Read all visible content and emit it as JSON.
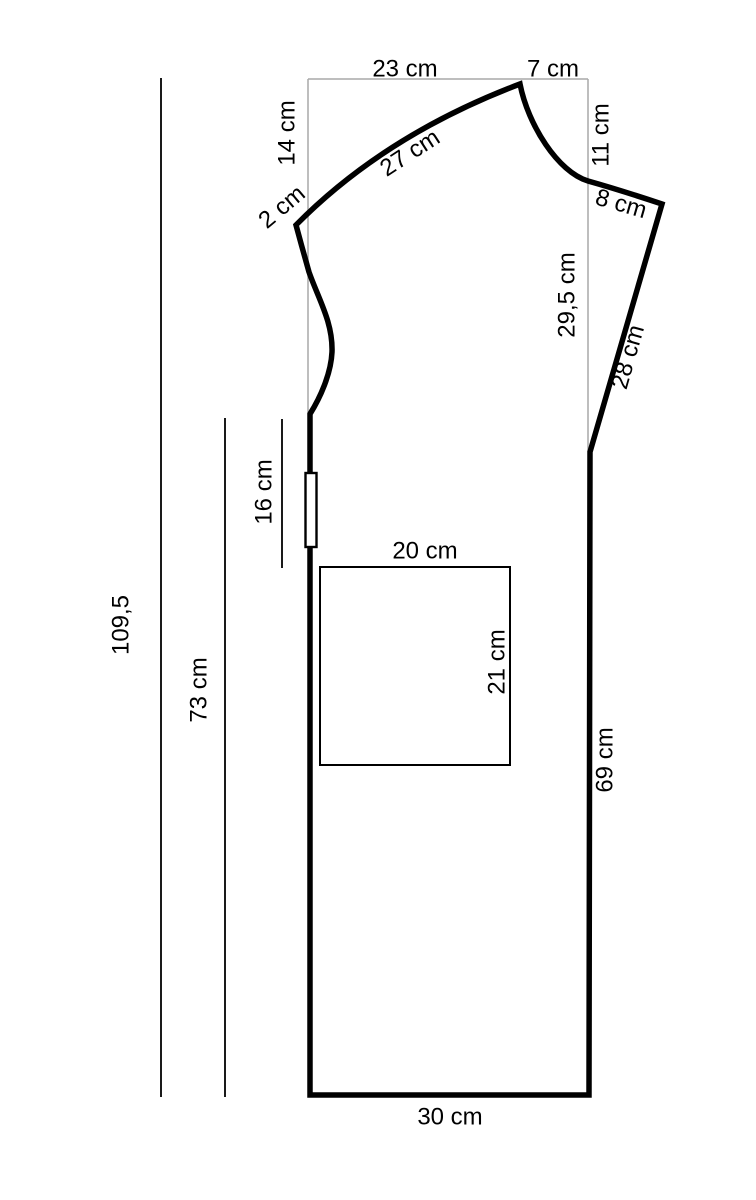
{
  "figure": {
    "type": "sewing-pattern-diagram",
    "colors": {
      "outline": "#000000",
      "reference_line": "#a9a9a9",
      "dimension_line": "#1a1a1a",
      "text": "#000000",
      "background": "#ffffff"
    },
    "measurements": {
      "top_width": "23 cm",
      "neck_width": "7 cm",
      "front_drop": "14 cm",
      "shoulder_seam": "27 cm",
      "notch": "2 cm",
      "neck_depth": "11 cm",
      "neck_curve": "8 cm",
      "armhole_depth": "29,5 cm",
      "raglan_side": "28 cm",
      "slit": "16 cm",
      "pocket_width": "20 cm",
      "pocket_height": "21 cm",
      "total_length": "109,5",
      "side_length": "73 cm",
      "right_side_length": "69 cm",
      "hem_width": "30 cm"
    }
  }
}
